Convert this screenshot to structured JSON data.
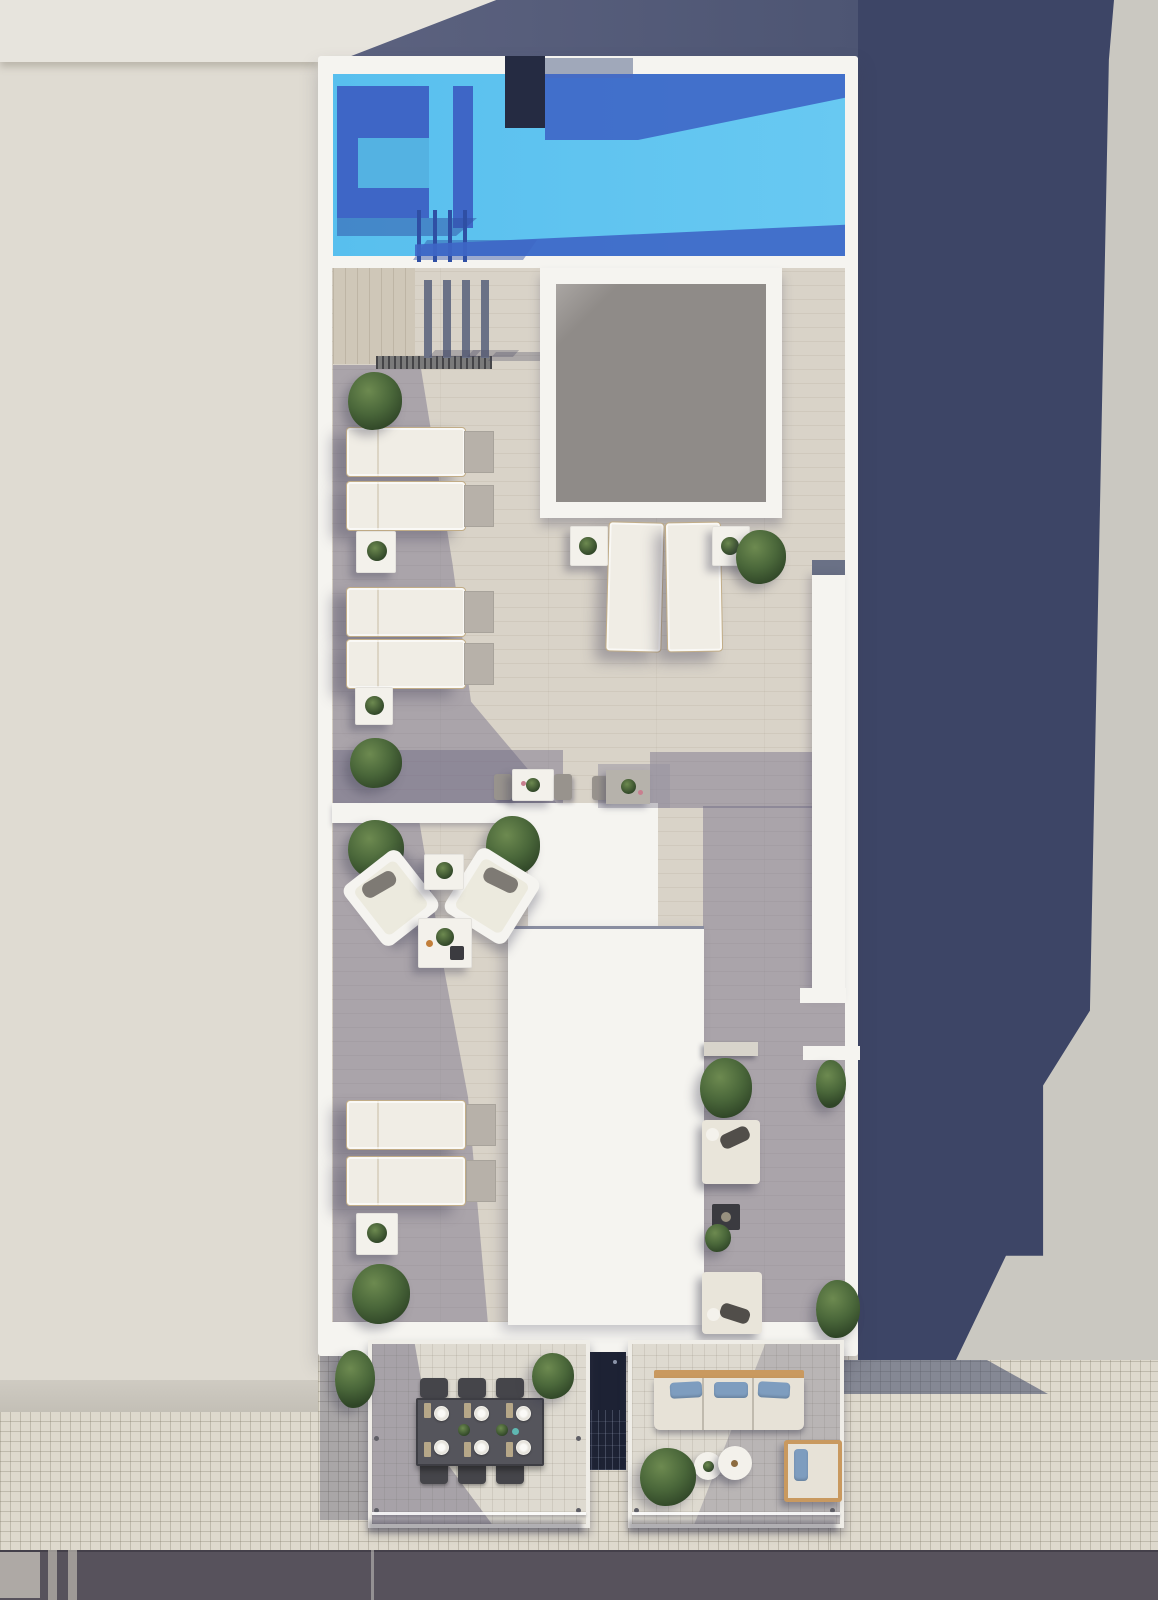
{
  "scene": {
    "type": "architectural-aerial-render",
    "subject": "Top-down 3D rendering of a rooftop terrace with swimming pool, skylight, two-level sun deck, two street-side balconies, neighbouring buildings and street",
    "view": "top-down aerial",
    "inventory": {
      "swimming_pool": 1,
      "pool_ladder_rails": 4,
      "pergola_posts": 4,
      "skylight": 1,
      "stairwell_glass_roof": 1,
      "sun_loungers": 8,
      "daybeds": 2,
      "lounge_armchairs": 2,
      "bistro_sets": 2,
      "coffee_tables": 2,
      "side_tables": 8,
      "dining_table": 1,
      "dining_chairs": 6,
      "place_settings": 6,
      "sofa": 1,
      "terrace_armchair": 1,
      "round_tables": 2,
      "fire_table": 1,
      "bench": 1,
      "bushes_planters": 14,
      "balconies": 2
    }
  },
  "colors": {
    "right_ground": "#cac8c1",
    "cast_shadow": "#3d4566",
    "left_building": "#dfdbd2",
    "left_building_light": "#e7e4dd",
    "wall_white": "#f5f4f0",
    "deck": "#d9d3c8",
    "slate_roof_a": "#5d6380",
    "slate_roof_b": "#4d5573",
    "slate_light": "#97a0b4",
    "post_slate": "#6a7186",
    "pool_water_a": "#58bfee",
    "pool_water_b": "#68c9f2",
    "pool_shadow": "#3e66c6",
    "pool_shadow_dark": "#2f4fa4",
    "pool_structure": "#252b42",
    "skylight_glass": "#8f8b88",
    "glass_dark": "#1d2234",
    "sidewalk": "#ded9cd",
    "road": "#57525c",
    "road_light": "#bdb9b1",
    "lounger_pad": "#f0ede5",
    "lounger_frame": "#c2ad87",
    "side_table_gray": "#b7b1a9",
    "table_white": "#f3f1eb",
    "bush_light": "#6d8a50",
    "bush_mid": "#4a673a",
    "bush_dark": "#2f4527",
    "dining_table": "#55555c",
    "chair_dark": "#45454a",
    "plate_white": "#efede8",
    "sofa_wood": "#c9995f",
    "sofa_body": "#e7e2d7",
    "pillow_blue": "#7e9dbf",
    "cushion_gray": "#7e7a74",
    "fire_table": "#3b3b40",
    "shade": "rgba(104,99,128,0.42)"
  }
}
